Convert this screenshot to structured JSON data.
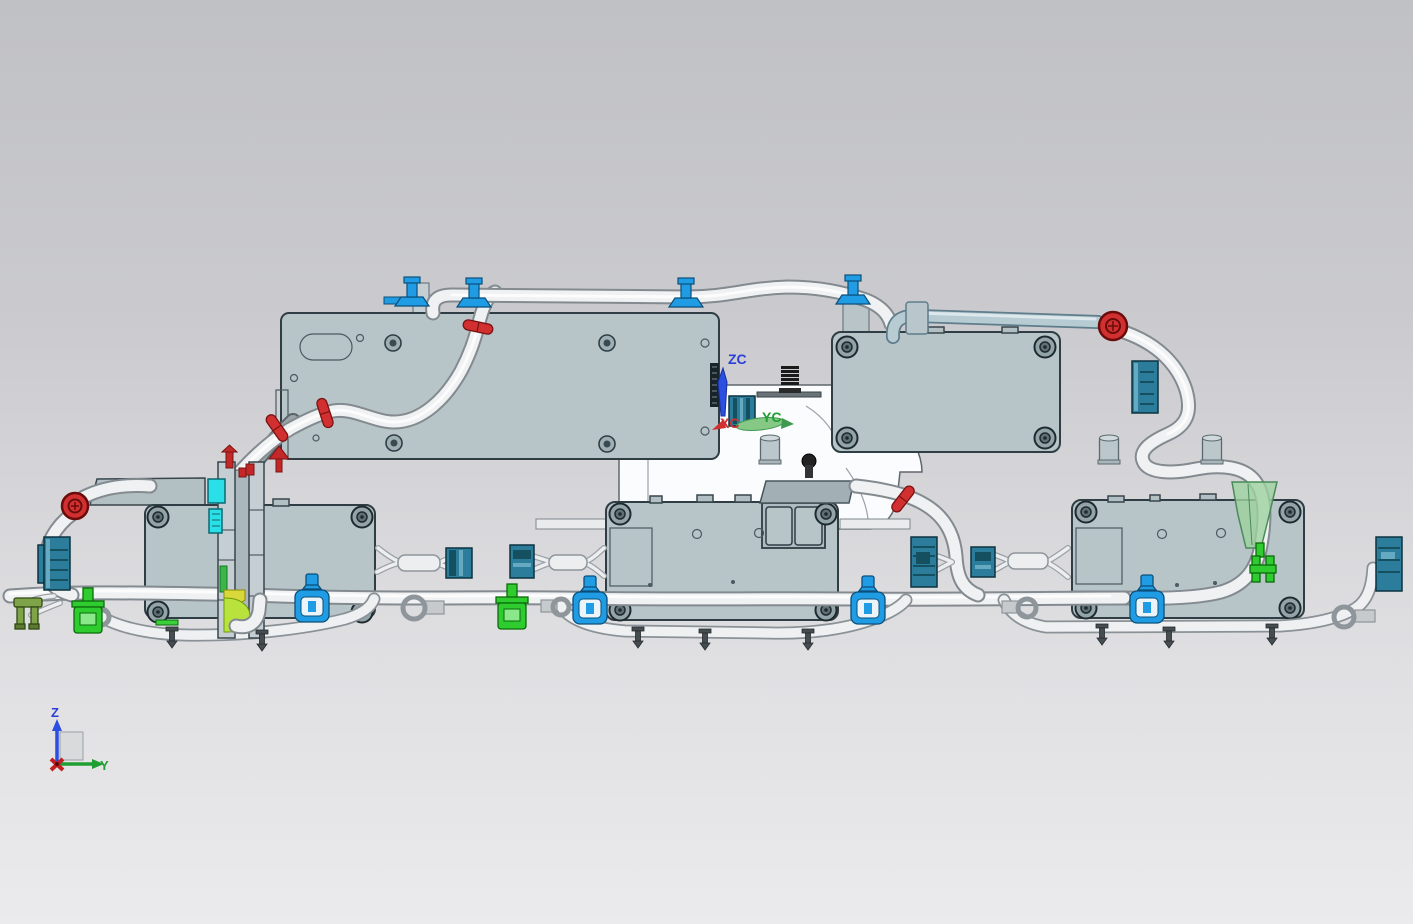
{
  "scene": {
    "type": "cad-assembly-viewport",
    "view_labels": {
      "wcs_z": "ZC",
      "wcs_y": "YC",
      "wcs_x": "XC",
      "triad_z": "Z",
      "triad_y": "Y"
    },
    "colors": {
      "background_top": "#c0c1c5",
      "background_bottom": "#ebebed",
      "box_fill": "#b7c4c8",
      "box_outline": "#2f3e44",
      "tube_fill": "#eff1f3",
      "tube_outline": "#838b90",
      "tube_light_blue": "#b7cbd3",
      "connector_teal": "#2b7d9b",
      "clip_blue": "#1f9ce3",
      "clip_red": "#d23030",
      "connector_green": "#2ecc2e",
      "connector_cyan": "#2bdfe8",
      "axis_z_blue": "#2b3fd8",
      "axis_y_green": "#1f9e33",
      "axis_x_red": "#d03030"
    }
  }
}
